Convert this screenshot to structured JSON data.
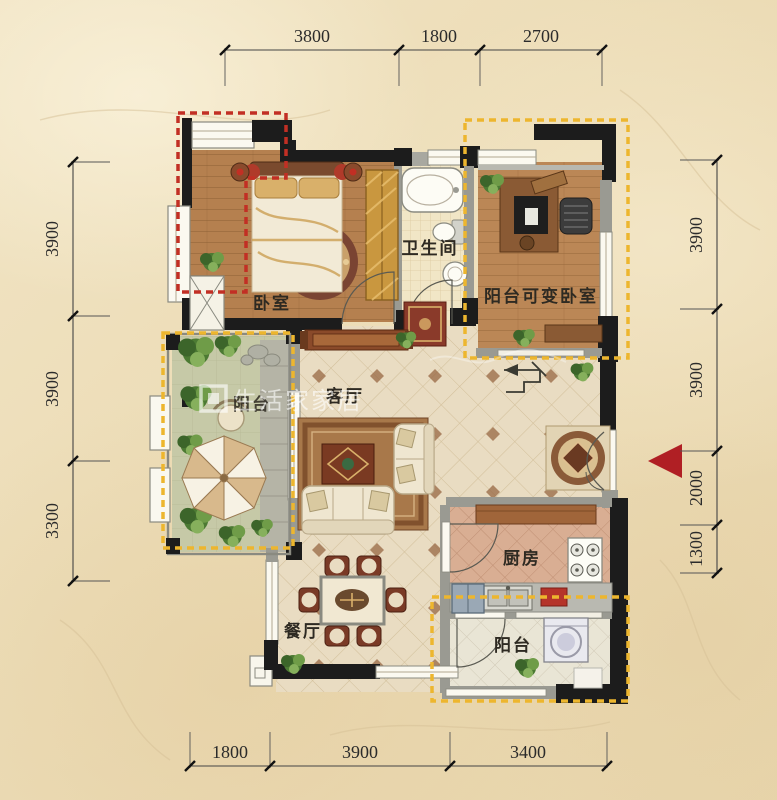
{
  "dimensions": {
    "top": [
      "3800",
      "1800",
      "2700"
    ],
    "bottom": [
      "1800",
      "3900",
      "3400"
    ],
    "left": [
      "3900",
      "3900",
      "3300"
    ],
    "right": [
      "3900",
      "3900",
      "2000",
      "1300"
    ]
  },
  "rooms": {
    "bedroom": "卧室",
    "bathroom": "卫生间",
    "convertible_bedroom": "阳台可变卧室",
    "living_room": "客厅",
    "kitchen": "厨房",
    "dining_room": "餐厅",
    "balcony_bottom": "阳台",
    "balcony_left": "阳台"
  },
  "watermark": {
    "logo_text": "生活家家居"
  },
  "colors": {
    "highlight_yellow": "#edb62e",
    "highlight_red": "#c22f24",
    "entry_arrow": "#b01f24"
  }
}
